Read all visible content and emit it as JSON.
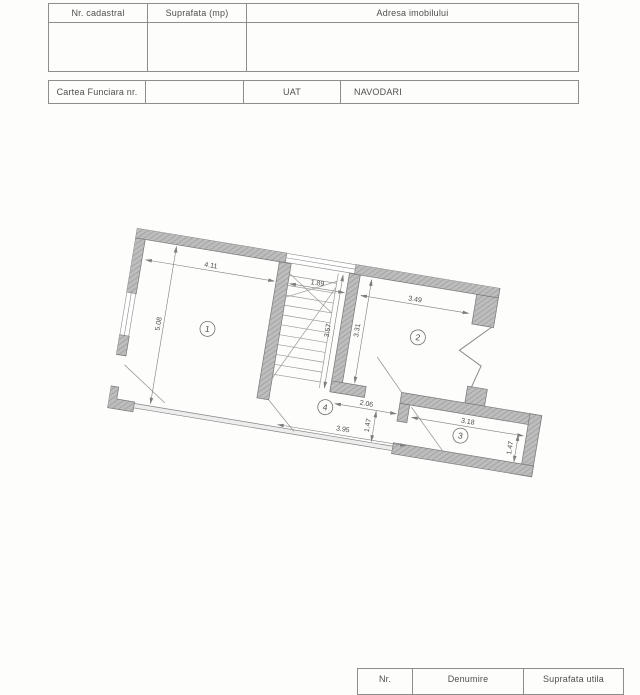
{
  "document": {
    "top_table": {
      "headers": [
        "Nr. cadastral",
        "Suprafata (mp)",
        "Adresa imobilului"
      ]
    },
    "cf_table": {
      "cf_label": "Cartea Funciara nr.",
      "uat_label": "UAT",
      "uat_value": "NAVODARI"
    },
    "bottom_table": {
      "headers": [
        "Nr.",
        "Denumire",
        "Suprafata utila"
      ]
    }
  },
  "floorplan": {
    "rooms": {
      "r1": "1",
      "r2": "2",
      "r3": "3",
      "r4": "4"
    },
    "dims": {
      "room1_width": "4.11",
      "room1_depth": "5.08",
      "stair_width": "1.89",
      "stair_depth": "3.57",
      "room2_width": "3.49",
      "room2_depth": "3.31",
      "passage_width": "2.06",
      "terrace_width": "3.95",
      "room3_width": "3.18",
      "room3_depth_left": "1.47",
      "room3_depth_right": "1.47"
    },
    "colors": {
      "wall": "#bdbdbd",
      "wall_hatch": "#9a9a9a",
      "line": "#7d7d7d"
    }
  }
}
